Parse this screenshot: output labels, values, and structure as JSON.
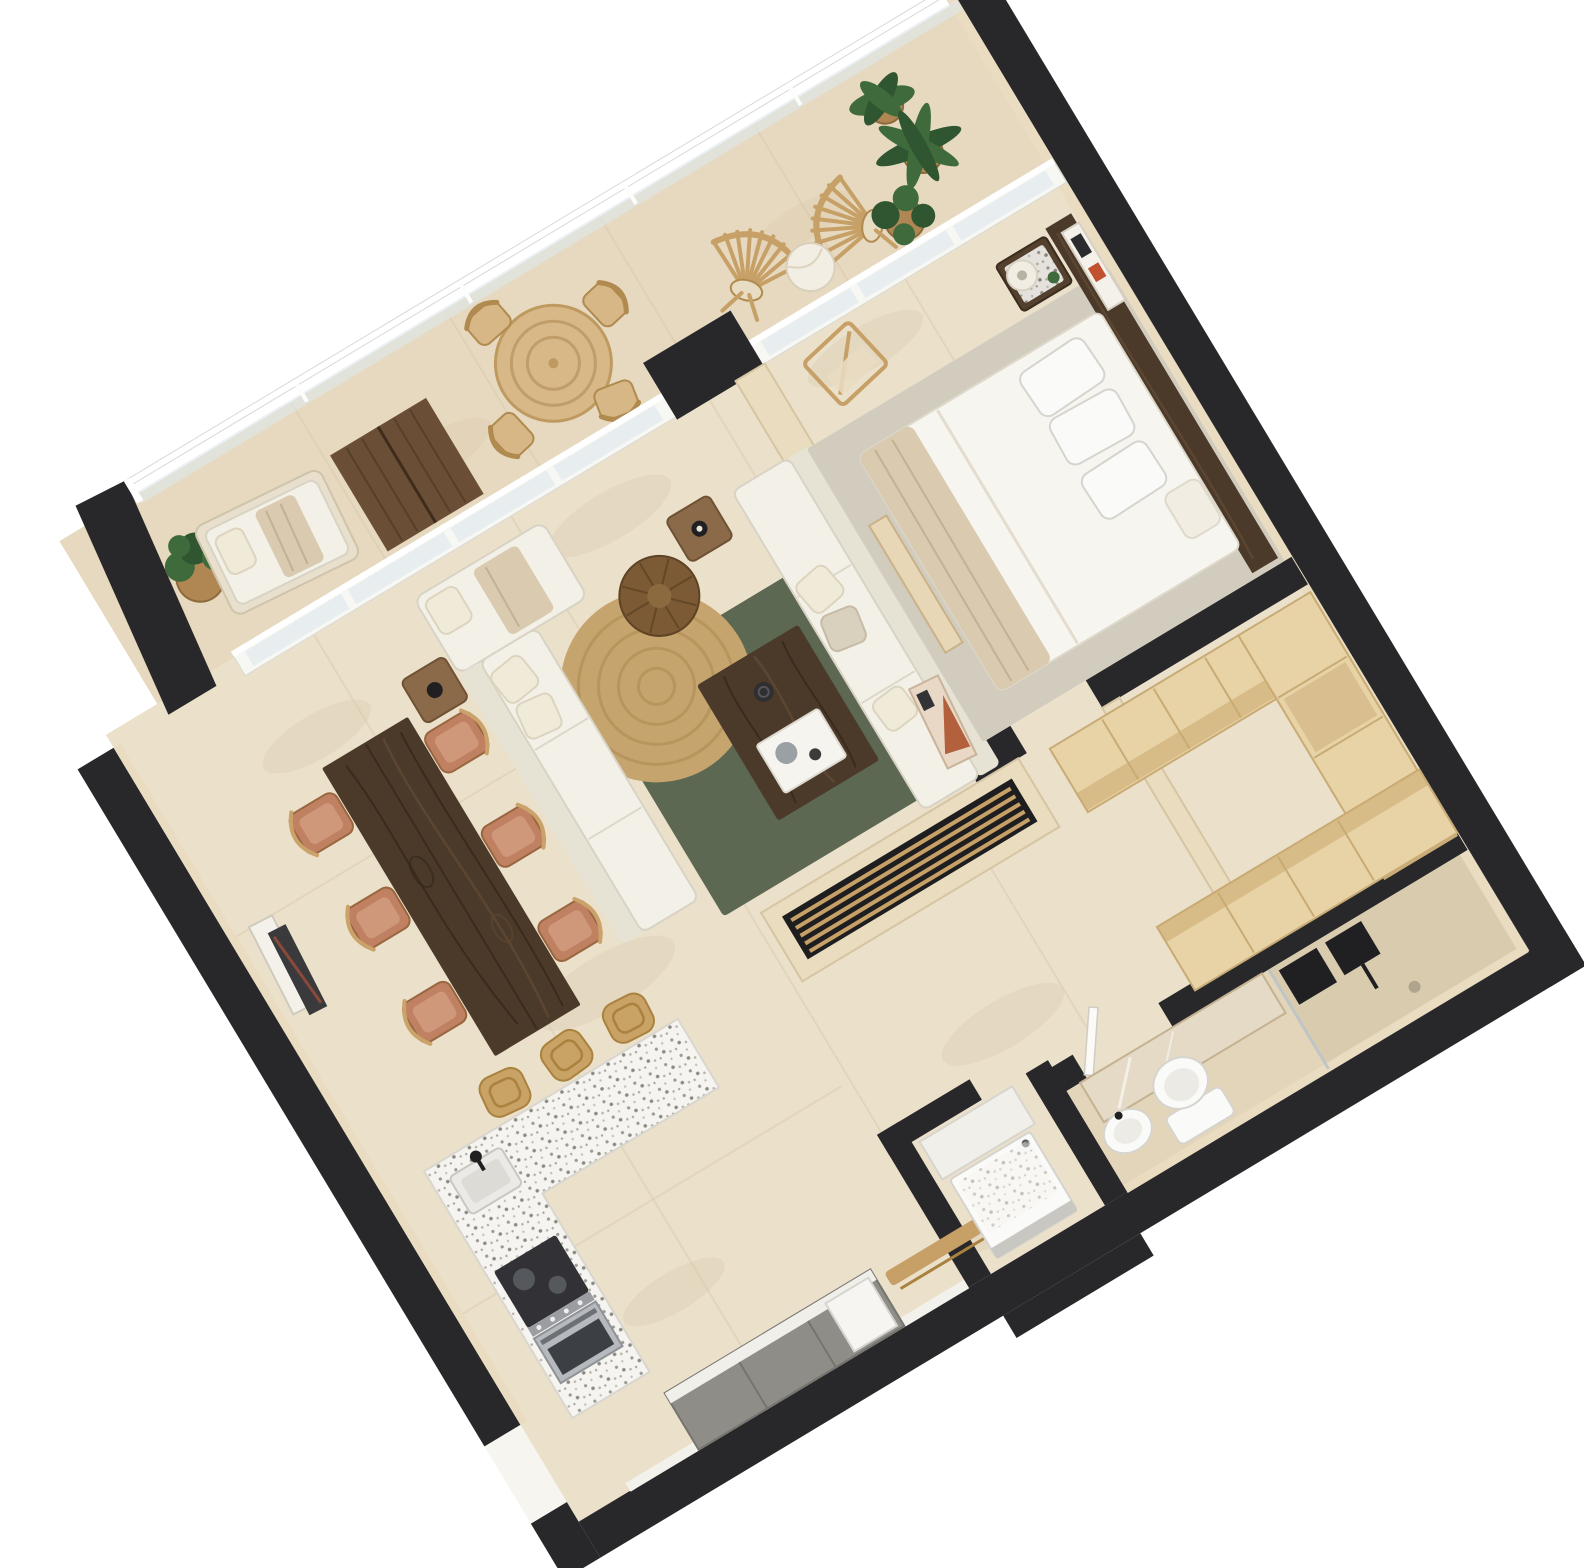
{
  "image": {
    "kind": "3d-rendered-floor-plan",
    "description": "Top-down isometric render of a one-bedroom apartment with wrap balcony",
    "plan_rotation_deg": -31,
    "canvas": {
      "width": 1584,
      "height": 1568
    }
  },
  "palette": {
    "background": "#ffffff",
    "wall": "#28282b",
    "wall_face": "#eadcc1",
    "wall_beige": "#e9dcbf",
    "wall_beige_edge": "#d6c5a3",
    "floor_main": "#ebe0ca",
    "floor_balcony": "#e6d9bf",
    "floor_bath": "#e3d5b9",
    "floor_shower": "#d9cbae",
    "tile_line": "#d6c7aa",
    "glass": "#dde8ec",
    "white_frame": "#f7f7f4",
    "rug_green": "#5d6852",
    "rug_gray": "#d2ccbf",
    "jute": "#c6a46e",
    "jute_ring": "#ad8950",
    "walnut": "#4b3a2a",
    "walnut_light": "#5f4832",
    "maple": "#e8d3a6",
    "maple_edge": "#c8ab76",
    "oak": "#c6a066",
    "rattan": "#c9a265",
    "leather": "#c08163",
    "leather_light": "#d2997417",
    "sofa": "#f3f0e8",
    "sofa_back": "#e6e2d4",
    "sofa_edge": "#d8d3c4",
    "throw": "#d9cab0",
    "terrazzo_base": "#f5f4f0",
    "stainless": "#b6b9bd",
    "appliance_dark": "#323236",
    "cabinet_gray": "#8f8d88",
    "counter_white": "#f1efe9",
    "fixture_white": "#fafaf8",
    "fixture_black": "#202022",
    "leaf": "#3f6b3c",
    "leaf_dark": "#2f5531",
    "pot": "#b08753",
    "wood_deck": "#6b4e36",
    "mirror": "#e4dac6"
  },
  "apartment": {
    "rooms": [
      {
        "id": "balcony",
        "furniture": [
          {
            "name": "glass-railing",
            "count": 1
          },
          {
            "name": "chaise-lounge",
            "count": 1
          },
          {
            "name": "potted-plant",
            "count": 4
          },
          {
            "name": "wood-deck-mat",
            "count": 1
          },
          {
            "name": "round-outdoor-table",
            "count": 1
          },
          {
            "name": "outdoor-dining-chair",
            "count": 4
          },
          {
            "name": "fan-slat-chair",
            "count": 2
          },
          {
            "name": "drum-side-table",
            "count": 1
          },
          {
            "name": "sliding-glass-door-wall",
            "count": 1
          }
        ]
      },
      {
        "id": "living-room",
        "furniture": [
          {
            "name": "sofa",
            "count": 2
          },
          {
            "name": "coffee-table",
            "count": 1
          },
          {
            "name": "green-area-rug",
            "count": 1
          },
          {
            "name": "round-jute-rug",
            "count": 1
          },
          {
            "name": "wicker-pouf",
            "count": 1
          },
          {
            "name": "side-table",
            "count": 2
          },
          {
            "name": "leaning-artwork",
            "count": 1
          },
          {
            "name": "tv-media-wall",
            "count": 1
          },
          {
            "name": "slatted-bench",
            "count": 1
          }
        ]
      },
      {
        "id": "dining-area",
        "furniture": [
          {
            "name": "dining-table",
            "count": 1
          },
          {
            "name": "dining-chair",
            "count": 6
          },
          {
            "name": "leaning-art-frame",
            "count": 2
          }
        ]
      },
      {
        "id": "kitchen",
        "furniture": [
          {
            "name": "terrazzo-island",
            "count": 1
          },
          {
            "name": "bar-stool",
            "count": 3
          },
          {
            "name": "sink",
            "count": 1
          },
          {
            "name": "black-faucet",
            "count": 1
          },
          {
            "name": "stove-oven",
            "count": 1
          },
          {
            "name": "cabinet-run",
            "count": 1
          },
          {
            "name": "integrated-appliance",
            "count": 1
          },
          {
            "name": "hall-bench",
            "count": 1
          }
        ]
      },
      {
        "id": "bedroom",
        "furniture": [
          {
            "name": "double-bed",
            "count": 1
          },
          {
            "name": "pillow",
            "count": 4
          },
          {
            "name": "walnut-headboard-panel",
            "count": 1
          },
          {
            "name": "nightstand",
            "count": 1
          },
          {
            "name": "table-lamp",
            "count": 1
          },
          {
            "name": "wall-art",
            "count": 1
          },
          {
            "name": "area-rug",
            "count": 1
          },
          {
            "name": "valet-chair",
            "count": 1
          },
          {
            "name": "foot-bench",
            "count": 1
          }
        ]
      },
      {
        "id": "walk-in-closet",
        "furniture": [
          {
            "name": "wardrobe-unit",
            "count": 3
          }
        ]
      },
      {
        "id": "bathroom",
        "furniture": [
          {
            "name": "vanity-mirror",
            "count": 1
          },
          {
            "name": "wash-basin",
            "count": 1
          },
          {
            "name": "toilet",
            "count": 1
          },
          {
            "name": "walk-in-shower",
            "count": 1
          },
          {
            "name": "shower-head",
            "count": 1
          },
          {
            "name": "shower-control",
            "count": 1
          },
          {
            "name": "glass-partition",
            "count": 1
          }
        ]
      },
      {
        "id": "laundry",
        "furniture": [
          {
            "name": "washing-machine",
            "count": 1
          },
          {
            "name": "laundry-counter",
            "count": 1
          }
        ]
      },
      {
        "id": "entry-hall",
        "furniture": [
          {
            "name": "entry-opening",
            "count": 1
          },
          {
            "name": "gray-cabinet-run",
            "count": 1
          }
        ]
      }
    ]
  }
}
